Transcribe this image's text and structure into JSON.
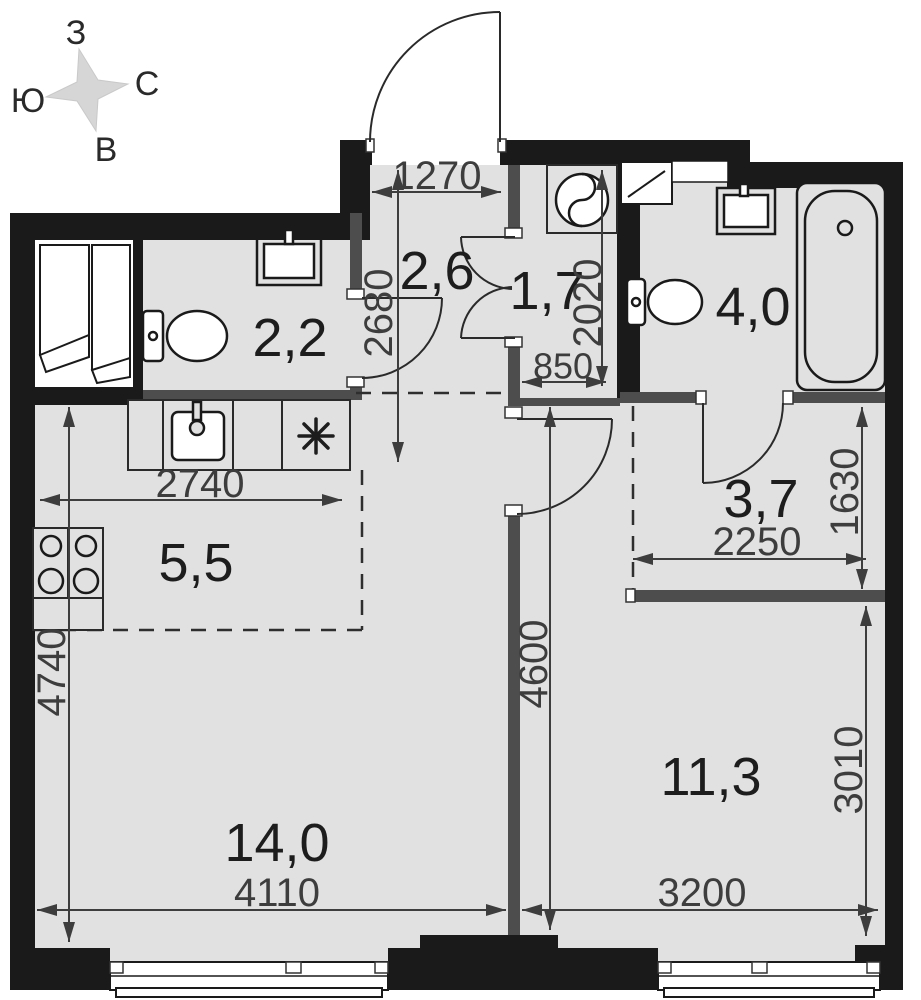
{
  "compass": {
    "west": "З",
    "north": "С",
    "south": "Ю",
    "east": "В"
  },
  "rooms": [
    {
      "name": "wc",
      "area": "2,2"
    },
    {
      "name": "hallway",
      "area": "2,6"
    },
    {
      "name": "laundry",
      "area": "1,7"
    },
    {
      "name": "bathroom",
      "area": "4,0"
    },
    {
      "name": "dressing",
      "area": "3,7"
    },
    {
      "name": "kitchen",
      "area": "5,5"
    },
    {
      "name": "living-room",
      "area": "14,0"
    },
    {
      "name": "bedroom",
      "area": "11,3"
    }
  ],
  "dimensions_mm": [
    {
      "name": "entry-width",
      "value": "1270"
    },
    {
      "name": "hallway-length",
      "value": "2680"
    },
    {
      "name": "laundry-depth",
      "value": "2020"
    },
    {
      "name": "laundry-width",
      "value": "850"
    },
    {
      "name": "kitchen-width",
      "value": "2740"
    },
    {
      "name": "dressing-width",
      "value": "2250"
    },
    {
      "name": "dressing-depth",
      "value": "1630"
    },
    {
      "name": "left-zone-depth",
      "value": "4740"
    },
    {
      "name": "center-depth",
      "value": "4600"
    },
    {
      "name": "bedroom-depth",
      "value": "3010"
    },
    {
      "name": "living-width",
      "value": "4110"
    },
    {
      "name": "bedroom-width",
      "value": "3200"
    }
  ],
  "colors": {
    "wall": "#1a1a1a",
    "partition": "#4d4d4d",
    "floor": "#e1e1e1",
    "dimension": "#3d3d3d",
    "compass_star": "#d6d6d6"
  }
}
